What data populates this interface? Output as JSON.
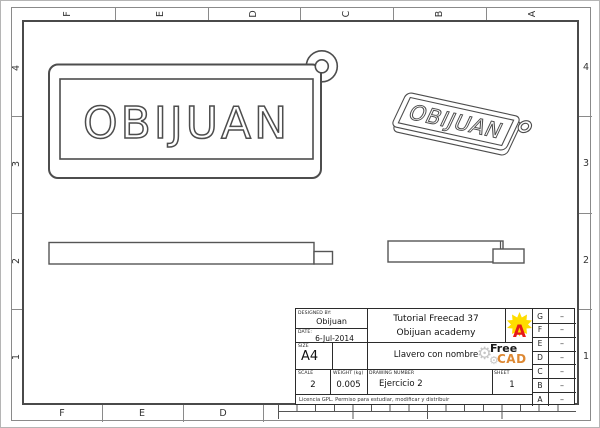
{
  "grid": {
    "top": [
      "F",
      "E",
      "D",
      "C",
      "B",
      "A"
    ],
    "bottom": [
      "F",
      "E",
      "D"
    ],
    "left": [
      "4",
      "3",
      "2",
      "1"
    ],
    "right": [
      "4",
      "3",
      "2",
      "1"
    ]
  },
  "views": {
    "part_text": "OBIJUAN"
  },
  "title_block": {
    "designed_by_label": "DESIGNED BY:",
    "designed_by": "Obijuan",
    "date_label": "DATE:",
    "date": "6-Jul-2014",
    "size_label": "SIZE",
    "size": "A4",
    "scale_label": "SCALE",
    "scale": "2",
    "weight_label": "WEIGHT  (kg)",
    "weight": "0.005",
    "drawing_number_label": "DRAWING NUMBER",
    "drawing_number": "Ejercicio 2",
    "sheet_label": "SHEET",
    "sheet": "1",
    "project_line1": "Tutorial Freecad 37",
    "project_line2": "Obijuan academy",
    "title": "Llavero con nombre",
    "license": "Licencia GPL. Permiso para estudiar, modificar y distribuir",
    "freecad_logo_line1": "Free",
    "freecad_logo_line2": "CAD",
    "obijuan_logo_letter": "A",
    "revisions": [
      {
        "label": "G",
        "mark": "–"
      },
      {
        "label": "F",
        "mark": "–"
      },
      {
        "label": "E",
        "mark": "–"
      },
      {
        "label": "D",
        "mark": "–"
      },
      {
        "label": "C",
        "mark": "–"
      },
      {
        "label": "B",
        "mark": "–"
      },
      {
        "label": "A",
        "mark": "–"
      }
    ]
  },
  "colors": {
    "line_gray": "#4d4d4d",
    "frame_dark": "#2b2b2b",
    "band_gray": "#8a8a8a",
    "logo_yellow": "#ffdd00",
    "logo_red": "#e61919",
    "freecad_orange": "#dd8833",
    "freecad_black": "#1a1a1a",
    "gear_gray": "#c6c6c6"
  }
}
